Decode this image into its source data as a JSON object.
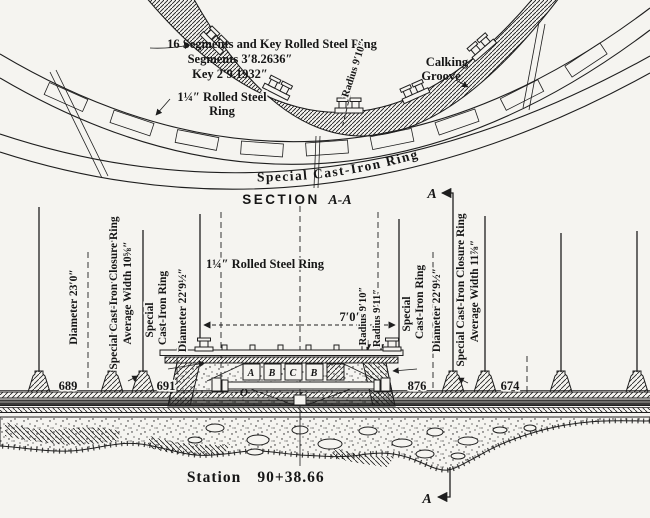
{
  "drawing": {
    "top_view": {
      "ring_note_line1": "16 Segments and Key Rolled Steel Ring",
      "ring_note_line2": "Segments 3′8.2636″",
      "ring_note_line3": "Key 2′9.1932″",
      "steel_ring_label_line1": "1¼″ Rolled Steel",
      "steel_ring_label_line2": "Ring",
      "calking_line1": "Calking",
      "calking_line2": "Groove",
      "radius_label": "Radius 9′10″",
      "cast_iron_ring_label": "Special Cast-Iron Ring"
    },
    "section_title": {
      "word": "SECTION",
      "cut": "A-A"
    },
    "section_view": {
      "steel_ring_label": "1¼″ Rolled Steel Ring",
      "width_dim": "7′0″",
      "radius_inner": "Radius 9′10″",
      "radius_outer": "Radius 9′11″",
      "left": {
        "diameter_outer": "Diameter 23′0″",
        "closure_ring_line1": "Special Cast-Iron Closure Ring",
        "closure_ring_line2": "Average Width 10⅝″",
        "ring_line1": "Special",
        "ring_line2": "Cast-Iron Ring",
        "diameter_inner": "Diameter 22′9½″"
      },
      "right": {
        "ring_line1": "Special",
        "ring_line2": "Cast-Iron Ring",
        "diameter_inner": "Diameter 22′9½″",
        "closure_ring_line1": "Special Cast-Iron Closure Ring",
        "closure_ring_line2": "Average Width 11⅞″"
      },
      "stake_numbers": [
        "689",
        "691",
        "876",
        "674"
      ],
      "pocket_letters": [
        "A",
        "B",
        "C",
        "B"
      ],
      "origin_label": "O",
      "station_word": "Station",
      "station_value": "90+38.66",
      "cut_letter": "A"
    }
  }
}
